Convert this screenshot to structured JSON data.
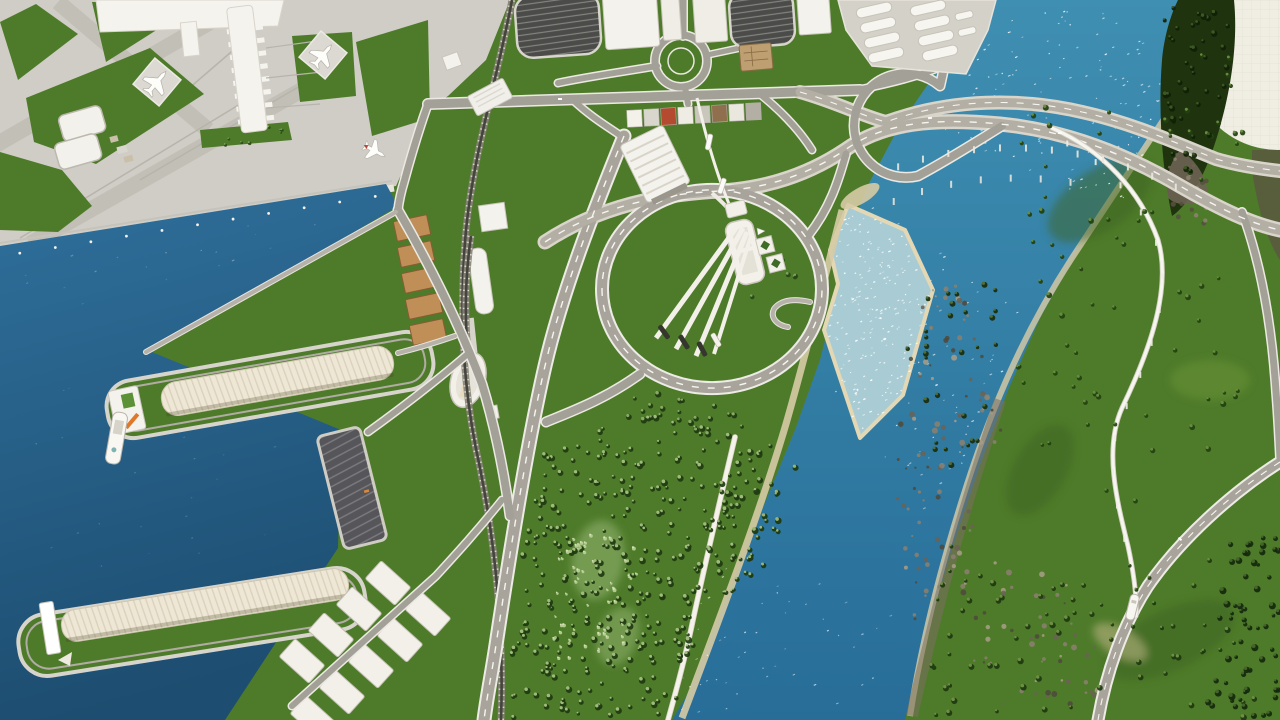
{
  "scene": {
    "name": "city-builder-aerial-view-airport-harbor-river-interchange"
  },
  "palette": {
    "grass": "#4e7b2a",
    "grass_dark": "#3c6420",
    "apron": "#d0cdc6",
    "apron_accent": "#c2bfb7",
    "apron_line": "#b7b4ac",
    "sea_top": "#2f709c",
    "sea_deep": "#1d4d70",
    "river_top": "#3f8fb2",
    "river_deep": "#276d98",
    "shoal": "#a9ccd4",
    "sand": "#d6cba4",
    "rock_band": "#7a7060",
    "building": "#f4f2ec",
    "building_stroke": "#c9c5bb",
    "warehouse": "#eee7d6",
    "warehouse_line": "#dbd2bc",
    "container": "#c08f57",
    "container_edge": "#8a5a33",
    "asphalt": "#4b4b49",
    "asphalt_stripe": "#83837e",
    "quay": "#55555a",
    "quay_stripe": "#7c7c80",
    "crane_orange": "#e0782a",
    "arena_blue": "#3f7fc1",
    "boat_dark": "#35362d",
    "monorail": "#f7f5ef",
    "ballast": "#868275",
    "rail_dark": "#45443e",
    "tie_light": "#d9d6c9",
    "embankment": "#e8e5de",
    "dome": "#f0ede3",
    "cliff_forest": "#20330f"
  },
  "generators": {
    "seed": 20240613,
    "road_kinds": {
      "st": {
        "casing": "#ebe9e2",
        "fill": "#a3a097",
        "extra": 3
      },
      "hw": {
        "casing": "#edebe5",
        "fill": "#a8a49b",
        "extra": 4,
        "dash": "#f6f5ef"
      },
      "br": {
        "casing": "#d9d5ca",
        "fill": "#b4afa5",
        "extra": 5,
        "dash": "#f6f5ef"
      },
      "lt": {
        "casing": "#e5e3dc",
        "fill": "#b6b2aa",
        "extra": 2
      },
      "pt": {
        "casing": "#d9d3c2",
        "fill": "#f4f2ea",
        "extra": 1.6
      }
    },
    "roads": [
      {
        "d": "M428,104 L860,90",
        "w": 9,
        "k": "st"
      },
      {
        "d": "M683,0 L683,36",
        "w": 7,
        "k": "st"
      },
      {
        "d": "M657,66 C622,72 592,76 558,83",
        "w": 6,
        "k": "st"
      },
      {
        "d": "M707,55 L754,45",
        "w": 5,
        "k": "st"
      },
      {
        "d": "M685,87 L688,104",
        "w": 6,
        "k": "st"
      },
      {
        "d": "M655,61 a26,26 0 1 0 52,0 a26,26 0 1 0 -52,0",
        "w": 7,
        "k": "st"
      },
      {
        "d": "M428,104 C418,132 411,156 404,182 C401,192 399,201 398,210",
        "w": 7,
        "k": "st"
      },
      {
        "d": "M573,100 C592,118 610,128 624,138",
        "w": 6,
        "k": "st"
      },
      {
        "d": "M624,136 C594,210 562,292 545,366 C528,440 511,545 496,645 C492,672 487,696 484,720",
        "w": 11,
        "k": "hw"
      },
      {
        "d": "M545,242 C600,206 660,194 720,191 C772,188 812,172 845,150 C884,122 935,118 1000,124 C1062,130 1122,152 1180,186 C1222,210 1252,224 1280,230",
        "w": 10,
        "k": "br"
      },
      {
        "d": "M800,92 C836,102 862,116 886,122 C952,98 1022,98 1082,112 C1132,123 1176,143 1216,159 C1240,166 1262,169 1280,171",
        "w": 9,
        "k": "br"
      },
      {
        "d": "M958,0 C951,32 946,60 940,86 A52,52 0 1 0 918,176 C948,160 976,142 1002,126",
        "w": 8,
        "k": "st"
      },
      {
        "d": "M862,89 C892,83 916,77 938,68",
        "w": 6,
        "k": "st"
      },
      {
        "d": "M602,289 a110,99 0 1 0 220,0 a110,99 0 1 0 -220,0",
        "w": 10,
        "k": "hw"
      },
      {
        "d": "M808,236 C830,208 838,182 846,154",
        "w": 7,
        "k": "st"
      },
      {
        "d": "M640,374 C604,400 570,412 546,422",
        "w": 8,
        "k": "st"
      },
      {
        "d": "M760,94 C780,110 798,128 812,150",
        "w": 6,
        "k": "st"
      },
      {
        "d": "M398,210 C428,262 458,320 482,384 C496,430 504,472 510,516",
        "w": 8,
        "k": "st"
      },
      {
        "d": "M470,352 C440,378 404,406 368,432",
        "w": 6,
        "k": "st"
      },
      {
        "d": "M502,500 C478,530 458,552 436,576 L292,706",
        "w": 6,
        "k": "st"
      },
      {
        "d": "M396,212 L146,352",
        "w": 4,
        "k": "lt"
      },
      {
        "d": "M455,336 C432,344 414,349 398,353",
        "w": 4,
        "k": "lt"
      },
      {
        "d": "M1280,462 C1230,494 1180,540 1148,586 C1122,626 1106,674 1098,720",
        "w": 9,
        "k": "hw"
      },
      {
        "d": "M1242,212 C1262,266 1272,330 1276,392 C1278,416 1279,438 1280,458",
        "w": 7,
        "k": "st"
      },
      {
        "d": "M810,302 C792,298 780,301 774,309 C770,317 776,325 788,327",
        "w": 4,
        "k": "lt"
      },
      {
        "d": "M735,437 C720,500 706,560 693,620 C684,664 674,698 668,720",
        "w": 4,
        "k": "pt"
      }
    ],
    "rails": [
      {
        "d": "M512,0 C498,76 474,150 466,230 C459,308 462,388 480,468 C496,548 504,636 501,720"
      },
      {
        "d": "M471,236 C465,278 464,320 469,362"
      }
    ],
    "monorail": {
      "d": "M1052,128 C1102,150 1140,190 1158,240 C1172,288 1150,350 1122,408 C1104,448 1116,498 1128,546 C1134,574 1137,596 1136,616"
    },
    "pole_lines": [
      {
        "d": "M2,256 L390,194",
        "gap": 36,
        "r": 1.4,
        "color": "#f4f3ee"
      }
    ],
    "tick_rows": [
      {
        "d": "M886,162 C950,136 1020,133 1080,145 C1128,154 1162,170 1188,184",
        "gap": 26,
        "w": 2,
        "h": 7,
        "dy": 6,
        "color": "#eae8df"
      },
      {
        "d": "M880,198 C940,170 1008,162 1078,174",
        "gap": 30,
        "w": 2,
        "h": 7,
        "dy": 6,
        "color": "#e6e4da"
      },
      {
        "d": "M1052,128 C1102,150 1140,190 1158,240 C1172,288 1150,350 1122,408 C1104,448 1116,498 1128,546",
        "gap": 34,
        "w": 2,
        "h": 6,
        "dy": 5,
        "color": "#efede6"
      }
    ],
    "tree_regions": [
      {
        "poly": [
          [
            545,
            450
          ],
          [
            645,
            412
          ],
          [
            725,
            432
          ],
          [
            790,
            458
          ],
          [
            762,
            555
          ],
          [
            705,
            650
          ],
          [
            668,
            720
          ],
          [
            505,
            720
          ],
          [
            515,
            600
          ],
          [
            530,
            505
          ]
        ],
        "n": 330,
        "r": [
          1.6,
          3.4
        ],
        "cs": [
          "#1e3a10",
          "#a6c383"
        ]
      },
      {
        "poly": [
          [
            596,
            382
          ],
          [
            706,
            398
          ],
          [
            790,
            448
          ],
          [
            736,
            446
          ],
          [
            640,
            424
          ],
          [
            598,
            398
          ]
        ],
        "n": 24,
        "r": [
          1.8,
          3.2
        ],
        "cs": [
          "#1e3a10",
          "#8fb06c"
        ]
      },
      {
        "poly": [
          [
            736,
            446
          ],
          [
            806,
            470
          ],
          [
            764,
            566
          ],
          [
            712,
            600
          ],
          [
            706,
            520
          ]
        ],
        "n": 30,
        "r": [
          1.8,
          3.4
        ],
        "cs": [
          "#1c380f",
          "#9dbb79"
        ]
      },
      {
        "poly": [
          [
            560,
            530
          ],
          [
            640,
            540
          ],
          [
            628,
            650
          ],
          [
            552,
            660
          ]
        ],
        "n": 55,
        "r": [
          1.0,
          2.0
        ],
        "cs": [
          "#b9d095",
          "#dce3bb"
        ]
      },
      {
        "poly": [
          [
            998,
            120
          ],
          [
            1240,
            40
          ],
          [
            1268,
            120
          ],
          [
            1150,
            260
          ],
          [
            1040,
            300
          ]
        ],
        "n": 40,
        "r": [
          1.6,
          3.0
        ],
        "cs": [
          "#22400f",
          "#6d8f44"
        ]
      },
      {
        "poly": [
          [
            1000,
            320
          ],
          [
            1240,
            260
          ],
          [
            1270,
            430
          ],
          [
            1150,
            520
          ],
          [
            1020,
            440
          ]
        ],
        "n": 36,
        "r": [
          1.6,
          3.0
        ],
        "cs": [
          "#22400f",
          "#6d8f44"
        ]
      },
      {
        "poly": [
          [
            940,
            540
          ],
          [
            1220,
            560
          ],
          [
            1260,
            720
          ],
          [
            920,
            720
          ]
        ],
        "n": 70,
        "r": [
          1.6,
          3.2
        ],
        "cs": [
          "#1d380e",
          "#73934a"
        ]
      },
      {
        "poly": [
          [
            1162,
            6
          ],
          [
            1230,
            6
          ],
          [
            1226,
            90
          ],
          [
            1196,
            180
          ],
          [
            1168,
            150
          ],
          [
            1160,
            60
          ]
        ],
        "n": 42,
        "r": [
          1.8,
          3.4
        ],
        "cs": [
          "#101f08",
          "#3f5c24"
        ]
      },
      {
        "poly": [
          [
            1226,
            540
          ],
          [
            1280,
            528
          ],
          [
            1280,
            720
          ],
          [
            1204,
            720
          ]
        ],
        "n": 64,
        "r": [
          1.8,
          3.6
        ],
        "cs": [
          "#14280c",
          "#48672c"
        ]
      },
      {
        "poly": [
          [
            734,
            208
          ],
          [
            802,
            232
          ],
          [
            806,
            292
          ],
          [
            744,
            300
          ]
        ],
        "n": 10,
        "r": [
          1.6,
          2.6
        ],
        "cs": [
          "#274716",
          "#86a862"
        ]
      },
      {
        "poly": [
          [
            202,
            130
          ],
          [
            288,
            124
          ],
          [
            290,
            140
          ],
          [
            204,
            146
          ]
        ],
        "n": 8,
        "r": [
          1.0,
          1.8
        ],
        "cs": [
          "#2c4c17",
          "#86a862"
        ]
      },
      {
        "poly": [
          [
            906,
            300
          ],
          [
            1000,
            280
          ],
          [
            1008,
            420
          ],
          [
            950,
            480
          ],
          [
            906,
            400
          ]
        ],
        "n": 30,
        "r": [
          1.6,
          3.0
        ],
        "cs": [
          "#182d0c",
          "#55703a"
        ]
      }
    ],
    "rock_regions": [
      {
        "poly": [
          [
            902,
            296
          ],
          [
            962,
            276
          ],
          [
            1006,
            420
          ],
          [
            962,
            560
          ],
          [
            918,
            646
          ],
          [
            894,
            500
          ]
        ],
        "n": 95,
        "r": [
          1.0,
          3.0
        ],
        "cs": [
          "#8b8070",
          "#6b6254",
          "#a79c86",
          "#4f4a3c"
        ]
      },
      {
        "poly": [
          [
            948,
            540
          ],
          [
            1052,
            556
          ],
          [
            1124,
            700
          ],
          [
            982,
            714
          ]
        ],
        "n": 60,
        "r": [
          1.0,
          3.0
        ],
        "cs": [
          "#8b8070",
          "#6b6254",
          "#a79c86",
          "#4f4a3c"
        ]
      },
      {
        "poly": [
          [
            1168,
            150
          ],
          [
            1216,
            150
          ],
          [
            1204,
            232
          ],
          [
            1164,
            216
          ]
        ],
        "n": 30,
        "r": [
          1.0,
          2.6
        ],
        "cs": [
          "#6e6353",
          "#55503f",
          "#8d8271"
        ]
      }
    ],
    "sparkle_regions": [
      {
        "poly": [
          [
            992,
            8
          ],
          [
            1230,
            16
          ],
          [
            1120,
            210
          ],
          [
            940,
            140
          ]
        ],
        "n": 150,
        "o": [
          0.35,
          0.95
        ]
      },
      {
        "poly": [
          [
            860,
            200
          ],
          [
            1030,
            300
          ],
          [
            960,
            470
          ],
          [
            930,
            520
          ],
          [
            820,
            380
          ]
        ],
        "n": 80,
        "o": [
          0.3,
          0.8
        ]
      },
      {
        "poly": [
          [
            848,
            205
          ],
          [
            905,
            230
          ],
          [
            933,
            290
          ],
          [
            903,
            395
          ],
          [
            860,
            438
          ],
          [
            824,
            330
          ],
          [
            838,
            284
          ],
          [
            830,
            250
          ]
        ],
        "n": 170,
        "o": [
          0.55,
          1.0
        ]
      },
      {
        "poly": [
          [
            710,
            560
          ],
          [
            900,
            600
          ],
          [
            880,
            720
          ],
          [
            664,
            718
          ]
        ],
        "n": 50,
        "o": [
          0.25,
          0.7
        ]
      },
      {
        "poly": [
          [
            20,
            262
          ],
          [
            360,
            206
          ],
          [
            372,
            218
          ],
          [
            30,
            326
          ]
        ],
        "n": 18,
        "o": [
          0.1,
          0.35
        ]
      },
      {
        "poly": [
          [
            20,
            370
          ],
          [
            300,
            440
          ],
          [
            240,
            640
          ],
          [
            16,
            560
          ]
        ],
        "n": 24,
        "o": [
          0.08,
          0.25
        ]
      }
    ]
  }
}
